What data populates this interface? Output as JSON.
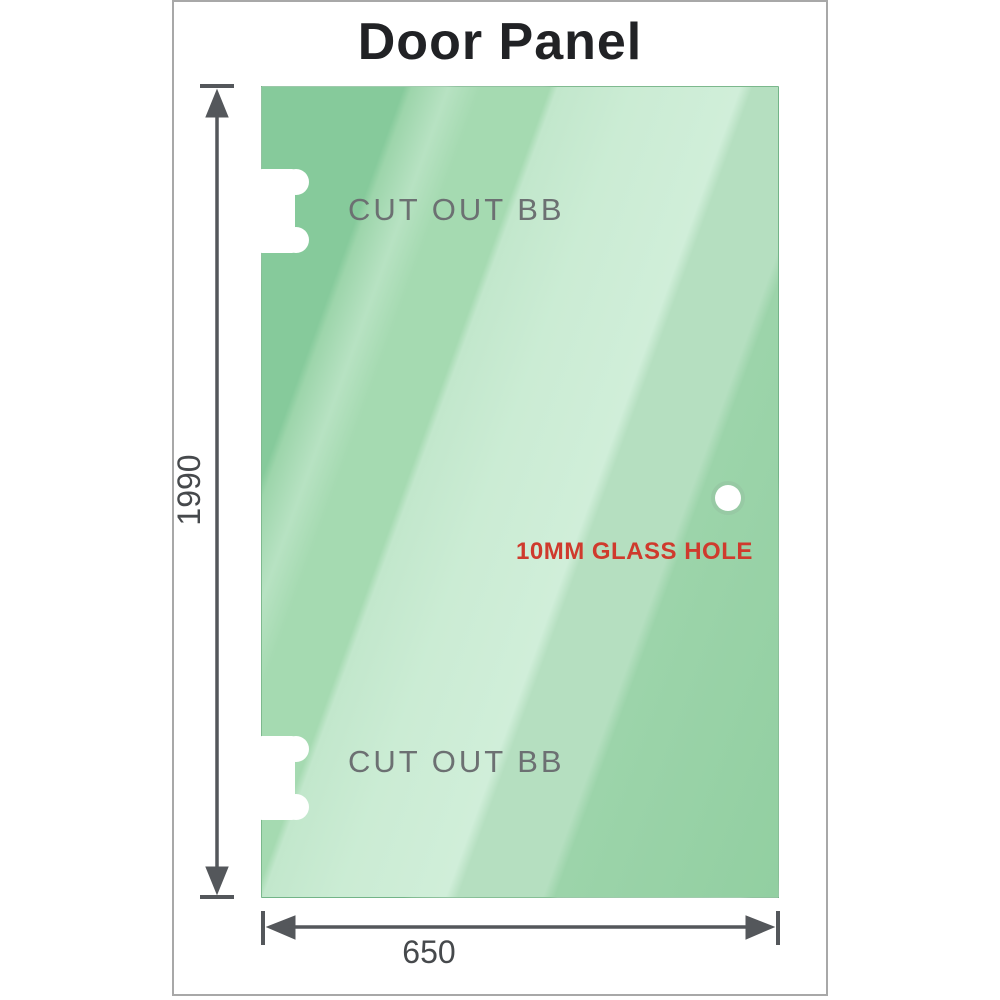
{
  "title": "Door Panel",
  "panel": {
    "glass_hole_label": "10MM GLASS HOLE",
    "hole_diameter_mm": 10
  },
  "cutouts": [
    {
      "label": "CUT OUT BB",
      "position": "top-left"
    },
    {
      "label": "CUT OUT BB",
      "position": "bottom-left"
    }
  ],
  "dimensions": {
    "height_label": "1990",
    "width_label": "650"
  },
  "colors": {
    "glass_base": "#86ca9b",
    "glass_highlight": "#d0eed9",
    "dimension_gray": "#54575b",
    "cutout_label_gray": "#6c7072",
    "glass_hole_red": "#cf3a2d",
    "title_dark": "#212225",
    "frame_border": "#a8a8a8"
  }
}
